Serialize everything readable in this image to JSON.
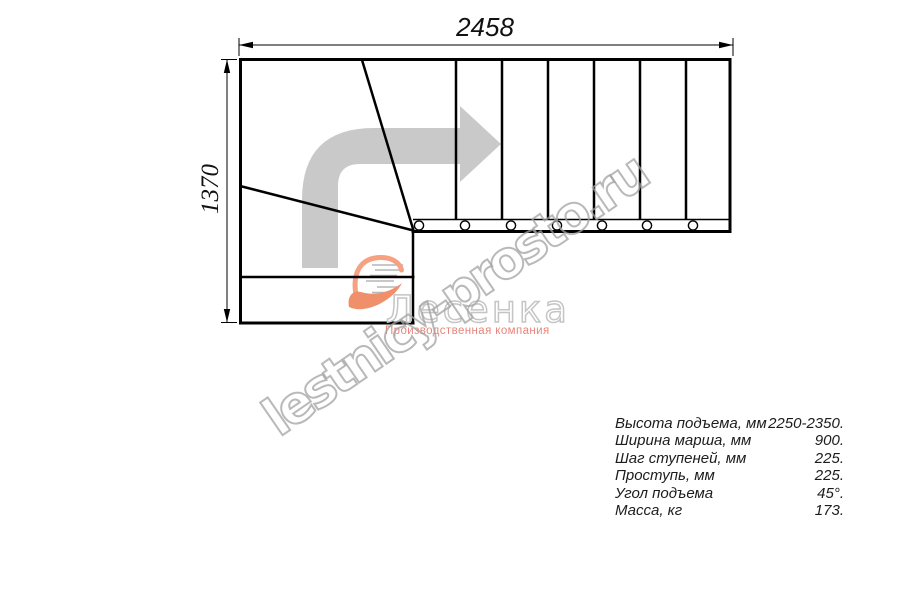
{
  "drawing": {
    "width_dim": "2458",
    "height_dim": "1370",
    "line_color": "#000000",
    "direction_arrow_color": "#c9c9c9"
  },
  "watermark": {
    "site_text": "lestnicy-prosto.ru",
    "logo_text": "Лесенка",
    "logo_subtitle": "Производственная компания",
    "accent_color": "#e8857a",
    "outline_color": "#b4b4b4"
  },
  "specs": {
    "rows": [
      {
        "label": "Высота подъема, мм",
        "value": "2250-2350."
      },
      {
        "label": "Ширина марша, мм",
        "value": "900."
      },
      {
        "label": "Шаг ступеней, мм",
        "value": "225."
      },
      {
        "label": "Проступь, мм",
        "value": "225."
      },
      {
        "label": "Угол подъема",
        "value": "45°."
      },
      {
        "label": "Масса, кг",
        "value": "173."
      }
    ]
  }
}
